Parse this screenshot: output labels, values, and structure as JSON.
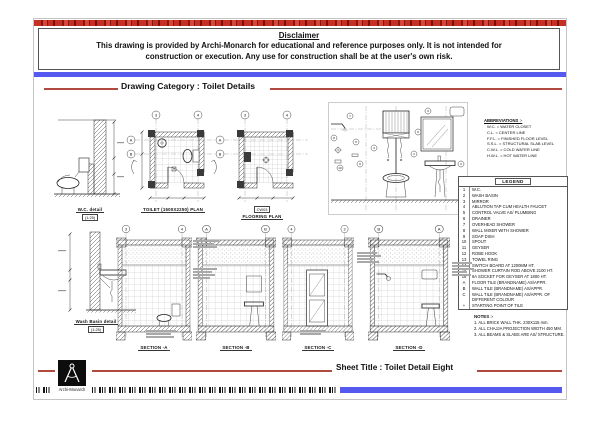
{
  "disclaimer": {
    "title": "Disclaimer",
    "line1": "This drawing is provided by Archi-Monarch for educational and reference purposes only. It is not intended for",
    "line2": "construction or execution. Any use for construction shall be at the user's own risk."
  },
  "header": {
    "category_label": "Drawing Category : Toilet Details"
  },
  "figures": {
    "wc_detail": {
      "title": "W.C. detail",
      "scale": "(1:25)"
    },
    "toilet_plan": {
      "title": "TOILET (1500X2250) PLAN",
      "grid_cols": [
        "3",
        "4"
      ],
      "grid_rows": [
        "A",
        "B"
      ]
    },
    "flooring_plan": {
      "title": "FLOORING PLAN",
      "tag": "CW03",
      "grid_cols": [
        "3",
        "4"
      ],
      "grid_rows": [
        "A",
        "B"
      ]
    },
    "elevation": {
      "callouts": [
        "7",
        "8",
        "5",
        "10",
        "9",
        "4",
        "1",
        "3",
        "2",
        "6"
      ]
    },
    "wash_basin_detail": {
      "title": "Wash Basin detail",
      "scale": "(1:25)"
    },
    "section_a": {
      "title": "SECTION -A",
      "grid": [
        "3",
        "4"
      ]
    },
    "section_b": {
      "title": "SECTION -B",
      "grid": [
        "A",
        "B"
      ]
    },
    "section_c": {
      "title": "SECTION -C",
      "grid": [
        "4",
        "3"
      ]
    },
    "section_d": {
      "title": "SECTION -D",
      "grid": [
        "B",
        "A"
      ]
    }
  },
  "abbreviations": {
    "title": "ABBREVIATIONS :-",
    "items": [
      "W.C. = WATER CLOSET",
      "C.L. = CENTER LINE",
      "F.F.L. = FINISHED FLOOR LEVEL",
      "S.S.L. = STRUCTURAL SLAB LEVEL",
      "C.W.L. = COLD WATER LINE",
      "H.W.L. = HOT WATER LINE"
    ]
  },
  "legend": {
    "title": "LEGEND",
    "rows": [
      {
        "no": "1",
        "desc": "W.C."
      },
      {
        "no": "2",
        "desc": "WASH BASIN"
      },
      {
        "no": "3",
        "desc": "MIRROR"
      },
      {
        "no": "4",
        "desc": "ABLUTION TAP CUM HEALTH FAUCET"
      },
      {
        "no": "5",
        "desc": "CONTROL VALVE AS/ PLUMBING"
      },
      {
        "no": "6",
        "desc": "DRAINER"
      },
      {
        "no": "7",
        "desc": "OVERHEAD SHOWER"
      },
      {
        "no": "8",
        "desc": "WALL MIXER WITH SHOWER"
      },
      {
        "no": "9",
        "desc": "SOAP DISH"
      },
      {
        "no": "10",
        "desc": "SPOUT"
      },
      {
        "no": "11",
        "desc": "GEYSER"
      },
      {
        "no": "12",
        "desc": "ROBE HOOK"
      },
      {
        "no": "13",
        "desc": "TOWEL RING"
      },
      {
        "no": "14",
        "desc": "SWITCH BOARD AT 1200MM HT."
      },
      {
        "no": "15",
        "desc": "SHOWER CURTAIN ROD ABOVE 2100 HT."
      },
      {
        "no": "16",
        "desc": "6A SOCKET FOR GEYSER AT 1800 HT."
      },
      {
        "no": "A",
        "desc": "FLOOR TILE (BRANDNAME) AS/APPR."
      },
      {
        "no": "B",
        "desc": "WALL TILE (BRANDNAME) AS/APPR."
      },
      {
        "no": "C",
        "desc": "WALL TILE (BRANDNAME) AS/APPR. OF DIFFERENT COLOUR"
      },
      {
        "no": "+",
        "desc": "STARTING POINT OF TILE"
      }
    ]
  },
  "notes": {
    "title": "NOTES :-",
    "items": [
      "1. ALL BRICK WALL THK. 230X115 mm.",
      "2. ALL CHAJJA PROJECTION WIDTH 450 MM.",
      "3. ALL BEAMS & SLABS ARE AS/ STRUCTURE."
    ]
  },
  "footer": {
    "sheet_title_label": "Sheet Title : Toilet Detail Eight",
    "brand": "Archi-Monarch"
  }
}
